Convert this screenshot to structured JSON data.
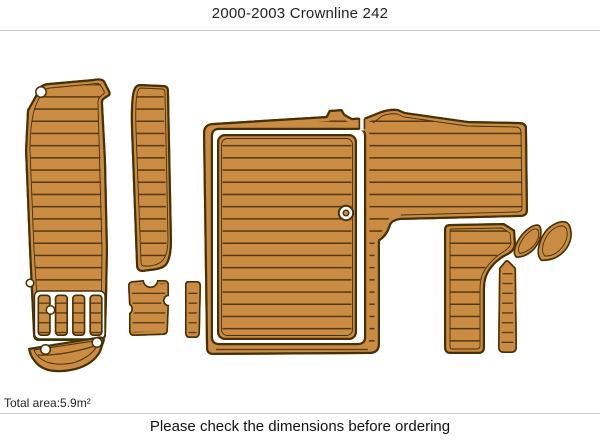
{
  "header": {
    "title": "2000-2003 Crownline 242"
  },
  "footer": {
    "total_area": "Total area:5.9m²",
    "note": "Please check the dimensions before ordering"
  },
  "colors": {
    "wood": "#c98c42",
    "outline": "#463009",
    "groove": "#54380f",
    "gap_white": "#ffffff",
    "separator": "#c9c9c9",
    "title_text": "#222222",
    "note_text": "#111111"
  },
  "diagram": {
    "pieces": [
      "swim-platform-pad",
      "swim-grate-slats",
      "swim-step-pad",
      "side-walkway-pad",
      "notched-step-pad",
      "small-strip-pad",
      "cockpit-surround-pad",
      "cockpit-hatch-pad",
      "bow-l-shaped-pad",
      "bow-center-strip-pad",
      "bow-wing-pad-small",
      "bow-wing-pad-large"
    ]
  }
}
